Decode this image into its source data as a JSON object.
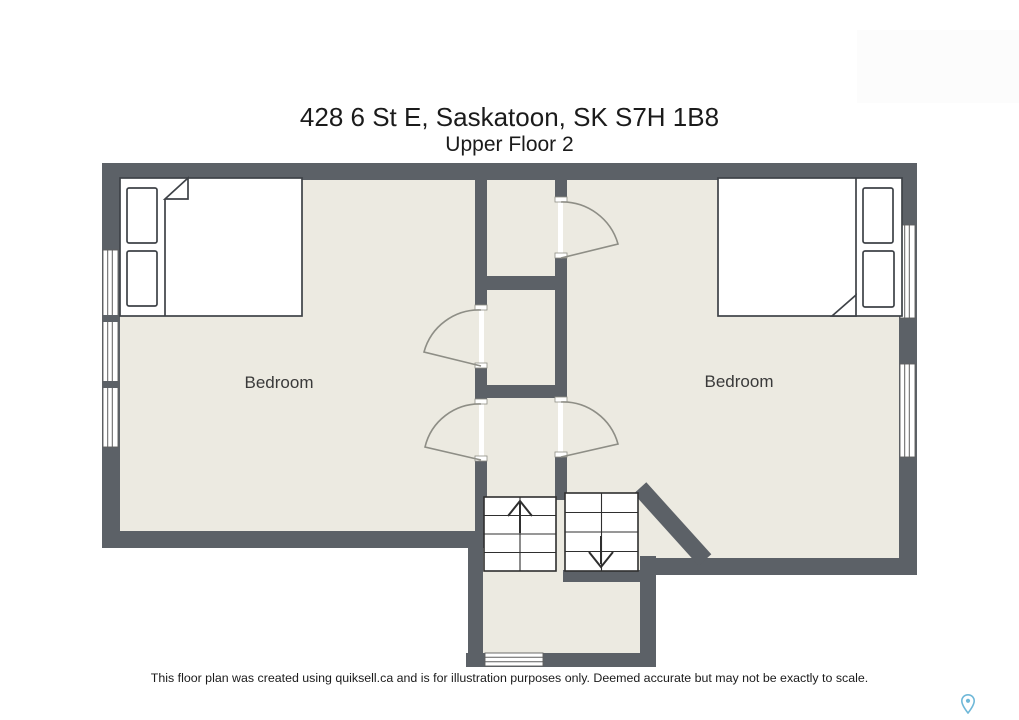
{
  "header": {
    "title": "428 6 St E, Saskatoon, SK S7H 1B8",
    "subtitle": "Upper Floor 2"
  },
  "rooms": [
    {
      "label": "Bedroom",
      "position": "left"
    },
    {
      "label": "Bedroom",
      "position": "right"
    }
  ],
  "footer": {
    "disclaimer": "This floor plan was created using quiksell.ca and is for illustration purposes only. Deemed accurate but may not be exactly to scale."
  },
  "colors": {
    "wall": "#5C6167",
    "floor": "#ECEAE1",
    "door_line": "#8E8E86",
    "furniture_line": "#3E4247",
    "stair_line": "#2F2F2F",
    "window_line": "#5F5F5F",
    "text": "#1B1B1B",
    "pin": "#6FB8D8"
  }
}
